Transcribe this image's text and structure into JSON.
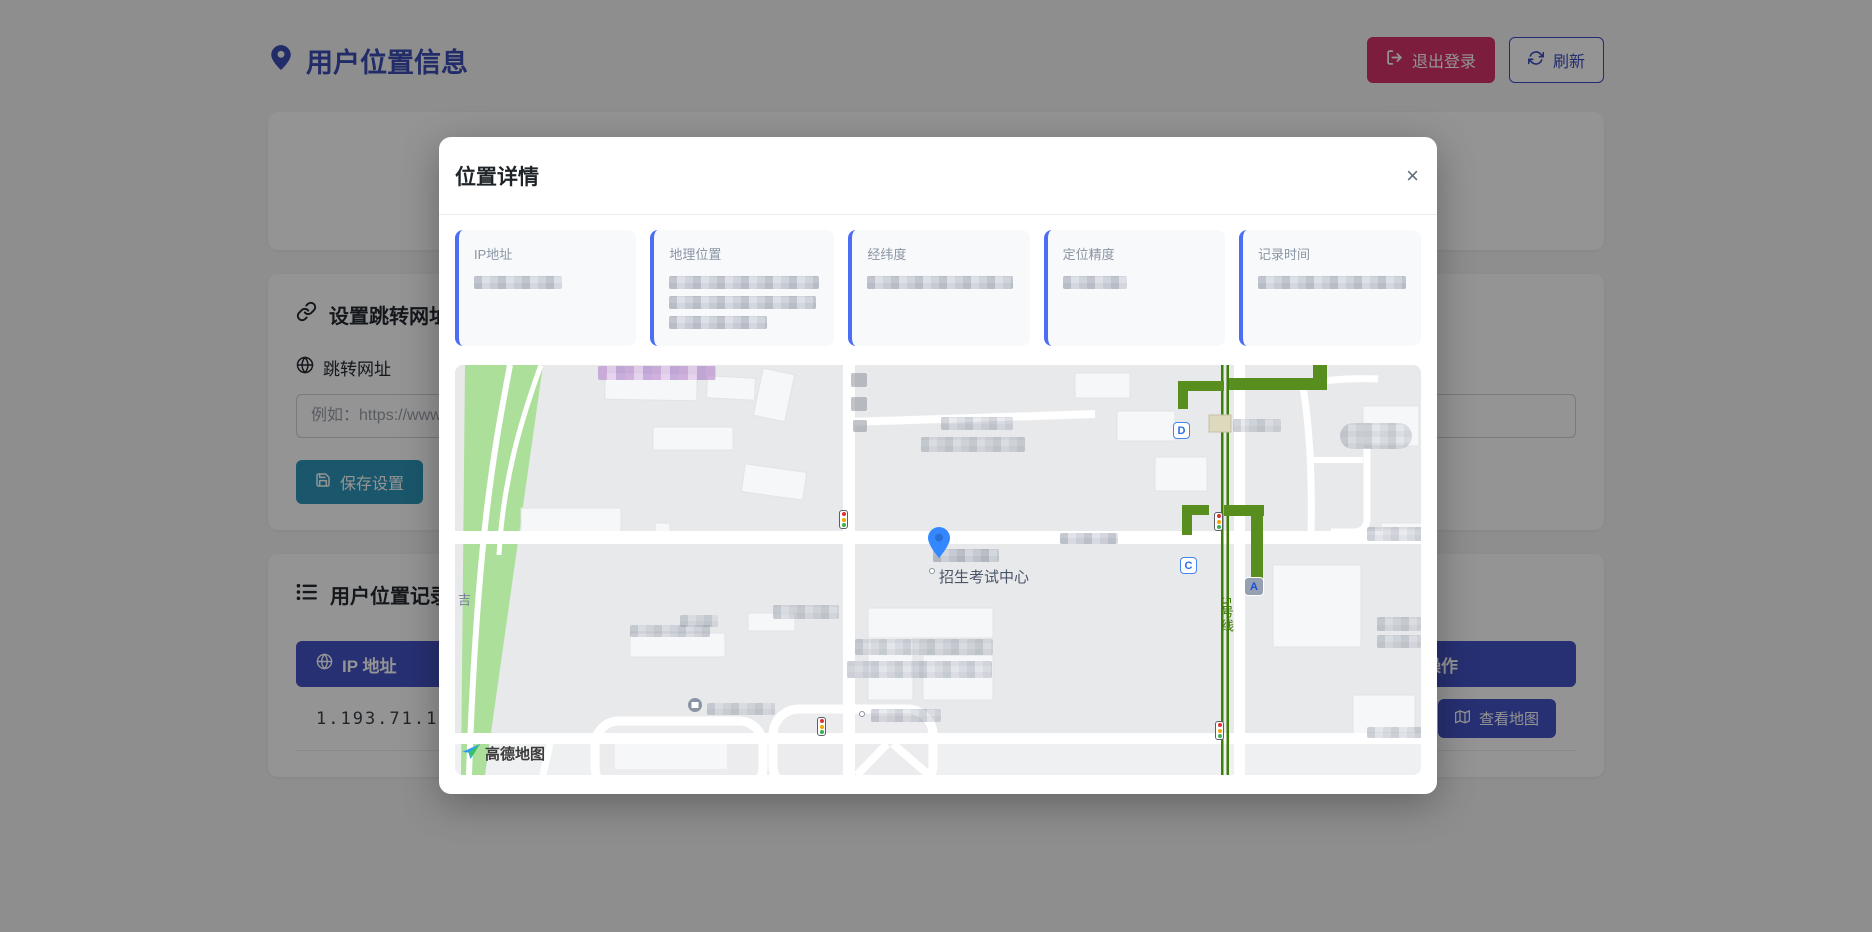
{
  "app": {
    "header": {
      "title": "用户位置信息",
      "logout": "退出登录",
      "refresh": "刷新"
    },
    "redirect": {
      "title": "设置跳转网址",
      "label": "跳转网址",
      "placeholder": "例如：https://www.",
      "save": "保存设置"
    },
    "records": {
      "title": "用户位置记录",
      "col_ip": "IP 地址",
      "col_action": "操作",
      "rows": [
        {
          "ip": "1.193.71.134",
          "action": "查看地图"
        }
      ]
    }
  },
  "modal": {
    "title": "位置详情",
    "close": "×",
    "fields": [
      {
        "label": "IP地址"
      },
      {
        "label": "地理位置"
      },
      {
        "label": "经纬度"
      },
      {
        "label": "定位精度"
      },
      {
        "label": "记录时间"
      }
    ],
    "map": {
      "poi": "招生考试中心",
      "subway_line": "5号线",
      "street": "吉",
      "provider": "高德地图",
      "exit_a": "A",
      "exit_c": "C",
      "exit_d": "D"
    }
  },
  "colors": {
    "accent": "#4453c6",
    "danger": "#d6336c",
    "save_teal": "#2e97ba",
    "field_border": "#4c6ef5",
    "metro_green": "#3d7e06",
    "park_green": "#abdf9a",
    "pin_blue": "#3388ff"
  }
}
